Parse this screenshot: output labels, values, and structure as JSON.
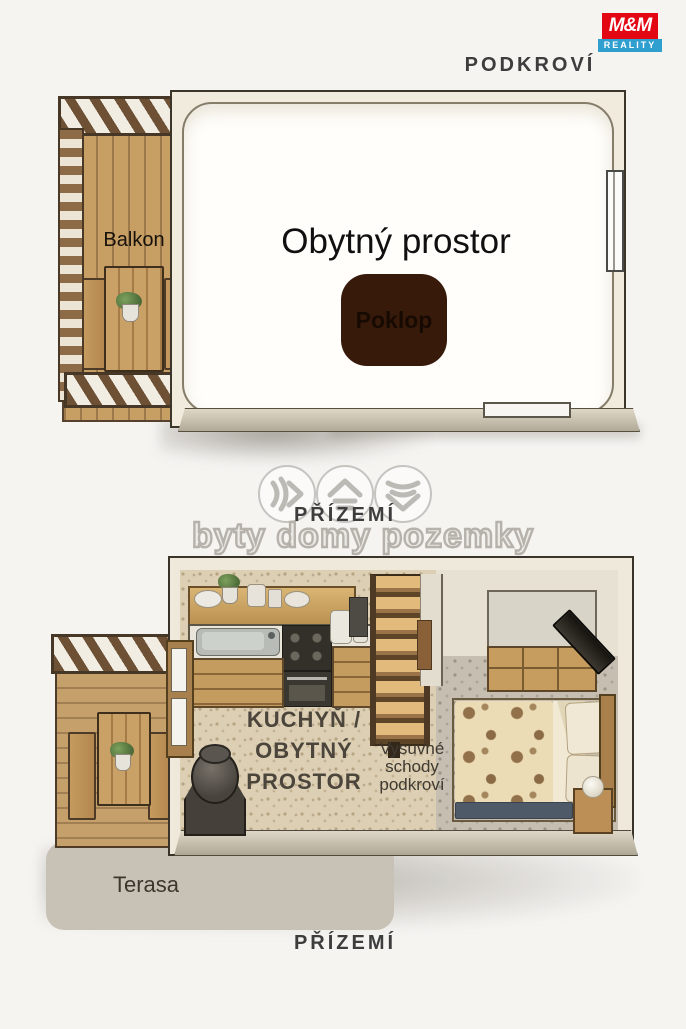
{
  "logo": {
    "brand": "M&M",
    "division": "REALITY"
  },
  "floors": {
    "attic_label": "PODKROVÍ",
    "ground_label_mid": "PŘÍZEMÍ",
    "ground_label_bottom": "PŘÍZEMÍ"
  },
  "attic_plan": {
    "balcony_label": "Balkon",
    "living_room_label": "Obytný prostor",
    "hatch_label": "Poklop"
  },
  "ground_plan": {
    "kitchen_living_label": "KUCHYŇ /\nOBYTNÝ\nPROSTOR",
    "attic_stairs_label": "Vysuvné\nschody\npodkroví",
    "terrace_label": "Terasa"
  },
  "watermark": {
    "tagline": "byty domy pozemky",
    "icons": [
      "signal-chevron-icon",
      "roof-lines-icon",
      "waves-chevron-icon"
    ]
  },
  "colors": {
    "logo_red": "#e30613",
    "logo_blue": "#2f9fd0",
    "hatch_brown": "#381a0b",
    "floor_label": "#3d3d3d",
    "wood": "#c79e63",
    "carpet_kitchen": "#ddcfb3",
    "carpet_bedroom": "#c6beb0"
  }
}
